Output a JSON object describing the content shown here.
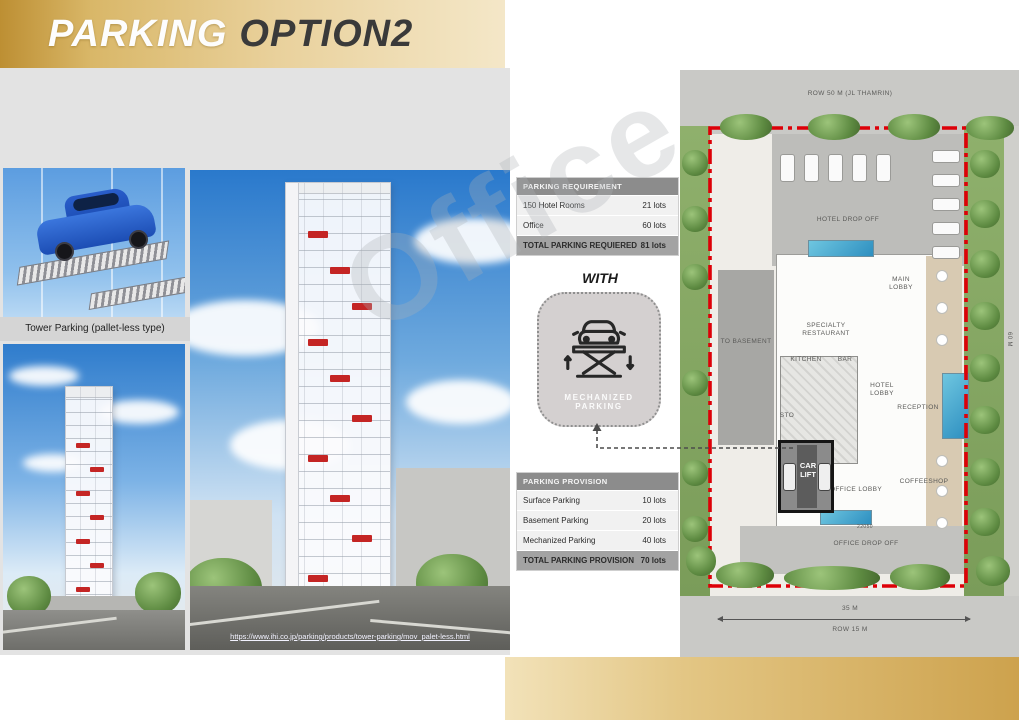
{
  "slide": {
    "title_part1": "PARKING",
    "title_part2": "OPTION2"
  },
  "left": {
    "caption": "Tower Parking (pallet-less type)",
    "link": "https://www.ihi.co.jp/parking/products/tower-parking/mov_palet-less.html"
  },
  "watermark": "Office",
  "requirement_table": {
    "header": "PARKING REQUIREMENT",
    "rows": [
      {
        "label": "150 Hotel Rooms",
        "value": "21 lots"
      },
      {
        "label": "Office",
        "value": "60 lots"
      }
    ],
    "total_label": "TOTAL PARKING REQUIERED",
    "total_value": "81 lots"
  },
  "with_label": "WITH",
  "badge": {
    "label": "MECHANIZED PARKING"
  },
  "provision_table": {
    "header": "PARKING PROVISION",
    "rows": [
      {
        "label": "Surface Parking",
        "value": "10 lots"
      },
      {
        "label": "Basement Parking",
        "value": "20 lots"
      },
      {
        "label": "Mechanized Parking",
        "value": "40 lots"
      }
    ],
    "total_label": "TOTAL PARKING PROVISION",
    "total_value": "70 lots"
  },
  "plan": {
    "row_top": "ROW 50 M (JL THAMRIN)",
    "hotel_drop_off": "HOTEL DROP OFF",
    "main_lobby": "MAIN LOBBY",
    "specialty_restaurant": "SPECIALTY RESTAURANT",
    "kitchen": "KITCHEN",
    "bar": "BAR",
    "hotel_lobby": "HOTEL LOBBY",
    "reception": "RECEPTION",
    "sto": "STO",
    "car_lift": "CAR LIFT",
    "office_lobby": "OFFICE LOBBY",
    "coffeeshop": "COFFEESHOP",
    "office_drop_off": "OFFICE DROP OFF",
    "to_basement": "TO BASEMENT",
    "dim_35": "35 M",
    "row_bottom": "ROW 15 M",
    "dim_60": "60 M",
    "dim_small": "22050"
  },
  "colors": {
    "accent_gold": "#d9b768",
    "boundary_red": "#dd0008",
    "pool_blue": "#3f9fc9",
    "table_header_gray": "#8c8c8c"
  }
}
